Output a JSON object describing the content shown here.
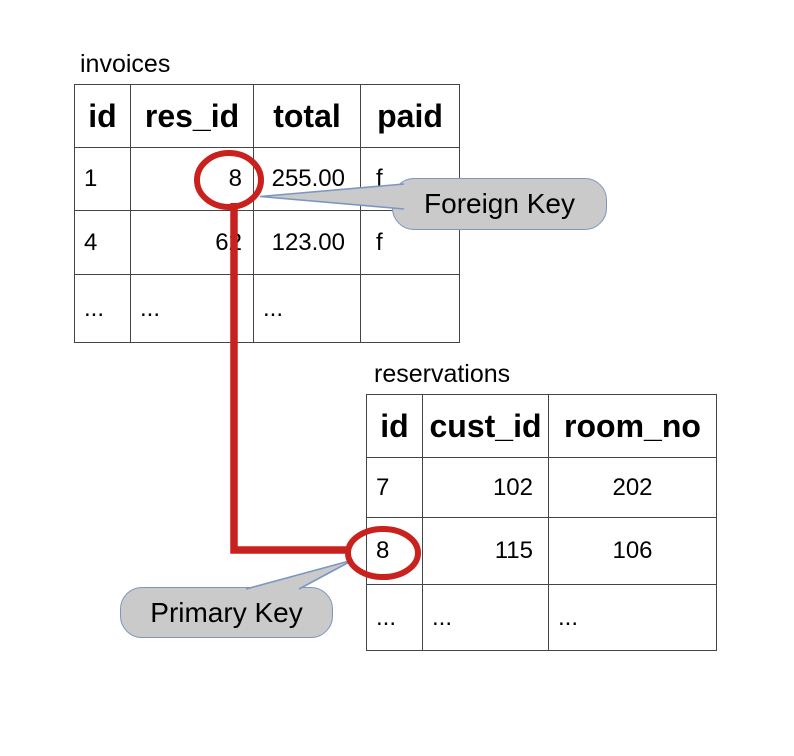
{
  "colors": {
    "red": "#c9211e",
    "callout-fill": "#cacaca",
    "callout-border": "#7b96c2",
    "table-border": "#444444",
    "text": "#000000",
    "background": "#ffffff"
  },
  "invoices_table": {
    "title": "invoices",
    "headers": [
      "id",
      "res_id",
      "total",
      "paid"
    ],
    "rows": [
      [
        "1",
        "8",
        "255.00",
        "f"
      ],
      [
        "4",
        "62",
        "123.00",
        "f"
      ],
      [
        "...",
        "...",
        "...",
        ""
      ]
    ]
  },
  "reservations_table": {
    "title": "reservations",
    "headers": [
      "id",
      "cust_id",
      "room_no"
    ],
    "rows": [
      [
        "7",
        "102",
        "202"
      ],
      [
        "8",
        "115",
        "106"
      ],
      [
        "...",
        "...",
        "..."
      ]
    ]
  },
  "callouts": {
    "foreign_key": {
      "label": "Foreign Key"
    },
    "primary_key": {
      "label": "Primary Key"
    }
  },
  "annotations": {
    "circled_invoices_res_id": "8",
    "circled_reservations_id": "8"
  }
}
